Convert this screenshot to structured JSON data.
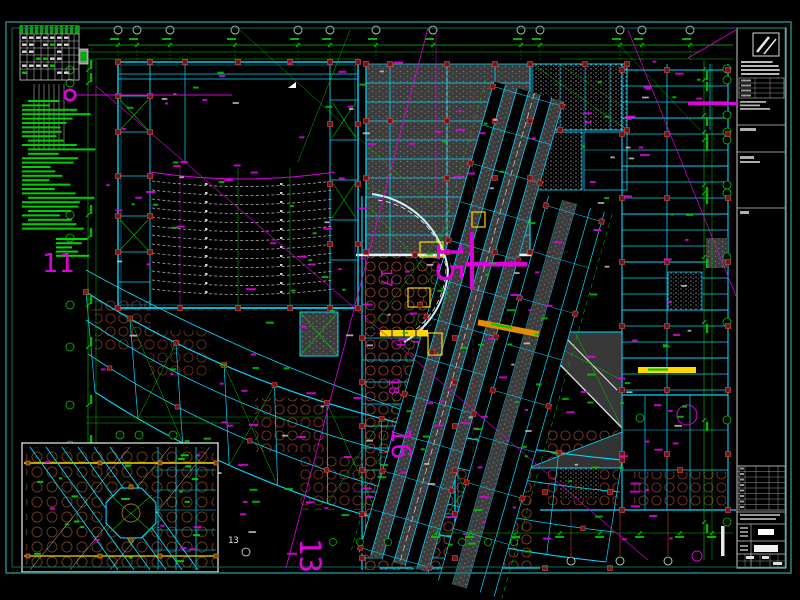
{
  "drawing": {
    "big_axis_labels": {
      "axis_11": "11",
      "axis_13": "13",
      "axis_15": "15",
      "axis_16": "16",
      "axis_17": "17",
      "axis_18": "18"
    },
    "grid_bubble_label_13": "13"
  },
  "colors": {
    "background": "#000000",
    "sheet_border": "#1e7d7d",
    "wall_cyan": "#00d8ff",
    "wall_bright": "#d8f6ff",
    "dim_green": "#00c800",
    "notes_green": "#00dc00",
    "center_magenta": "#e000e0",
    "column_fill_red": "#6f1a1a",
    "column_edge_red": "#d04040",
    "hatch_circle_red": "#93402e",
    "hatch_circle_orange": "#b46a28",
    "slab_gray": "#3c3c3c",
    "highlight_yellow": "#ffd800",
    "highlight_orange": "#e09000",
    "seat_gray": "#b4b4b4",
    "titleblock_gray": "#c8c8c8",
    "inset_border_white": "#f0f0f0"
  }
}
